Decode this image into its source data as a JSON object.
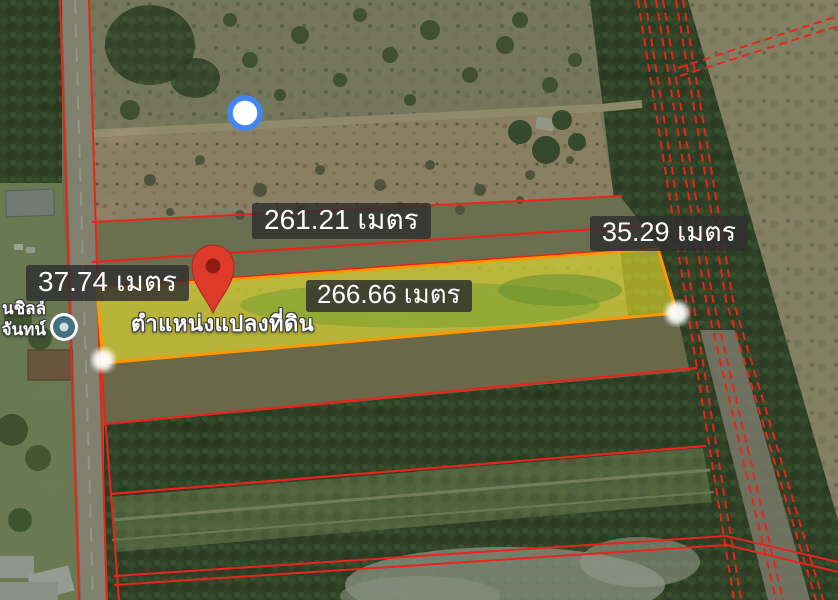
{
  "title": "Land plot satellite map",
  "measurements": {
    "top": "261.21 เมตร",
    "right": "35.29 เมตร",
    "left": "37.74 เมตร",
    "bottom": "266.66 เมตร"
  },
  "pin_label": "ตำแหน่งแปลงที่ดิน",
  "poi_label": {
    "line1": "นชิลล์",
    "line2": "จันทน์"
  },
  "icons": {
    "pin": "location-pin",
    "poi": "place-marker",
    "gps_dot": "blue-point-marker",
    "vertex_dot": "white-vertex-marker"
  },
  "colors": {
    "boundary_red": "#e8241d",
    "plot_fill": "#e6df2a",
    "plot_border": "#ff9800",
    "label_bg": "rgba(48,48,48,0.84)",
    "label_text": "#ffffff",
    "pin_red": "#dd3a2b",
    "poi_teal": "#41707e",
    "gps_blue": "#4285f4"
  }
}
